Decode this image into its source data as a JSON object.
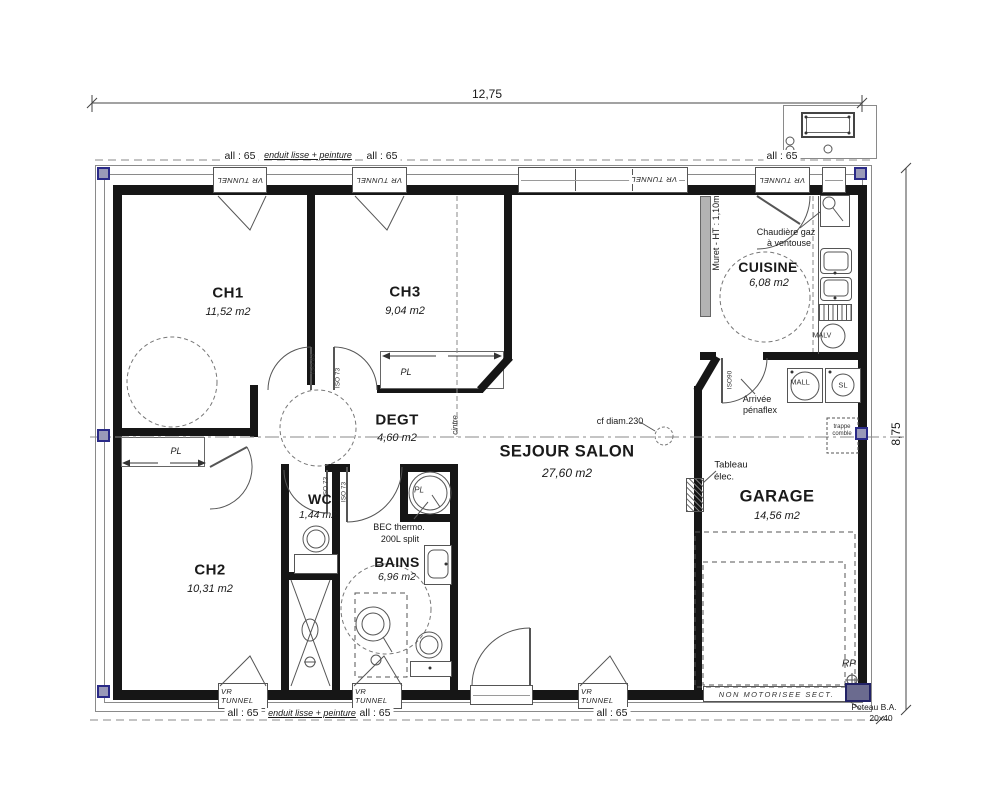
{
  "dimensions": {
    "width_label": "12,75",
    "height_label": "8,75"
  },
  "rooms": {
    "ch1": {
      "name": "CH1",
      "area": "11,52 m2"
    },
    "ch2": {
      "name": "CH2",
      "area": "10,31 m2"
    },
    "ch3": {
      "name": "CH3",
      "area": "9,04 m2"
    },
    "degt": {
      "name": "DEGT",
      "area": "4,60 m2"
    },
    "wc": {
      "name": "WC",
      "area": "1,44 m2"
    },
    "bains": {
      "name": "BAINS",
      "area": "6,96 m2"
    },
    "sejour": {
      "name": "SEJOUR SALON",
      "area": "27,60 m2"
    },
    "cuisine": {
      "name": "CUISINE",
      "area": "6,08 m2"
    },
    "garage": {
      "name": "GARAGE",
      "area": "14,56 m2"
    }
  },
  "windows": {
    "label": "VR TUNNEL"
  },
  "finishes": {
    "allege": "all : 65",
    "enduit": "enduit lisse + peinture"
  },
  "doors": {
    "iso83": "ISO 83",
    "iso73": "ISO 73",
    "iso90": "ISO90"
  },
  "closets": {
    "pl": "PL"
  },
  "equipment": {
    "malv": "MALV",
    "mall": "MALL",
    "sl": "SL",
    "bec_line1": "BEC thermo.",
    "bec_line2": "200L split",
    "chaudiere_line1": "Chaudière gaz",
    "chaudiere_line2": "à ventouse"
  },
  "annotations": {
    "muret": "Muret - HT : 1,10m",
    "cf_diam": "cf diam.230",
    "cintre": "cintre",
    "tableau_line1": "Tableau",
    "tableau_line2": "élec.",
    "arrivee_line1": "Arrivée",
    "arrivee_line2": "pénaflex",
    "trappe_line1": "trappe",
    "trappe_line2": "comble",
    "rp": "RP",
    "garage_door": "NON MOTORISEE SECT.",
    "poteau_line1": "Poteau B.A.",
    "poteau_line2": "20x40"
  }
}
